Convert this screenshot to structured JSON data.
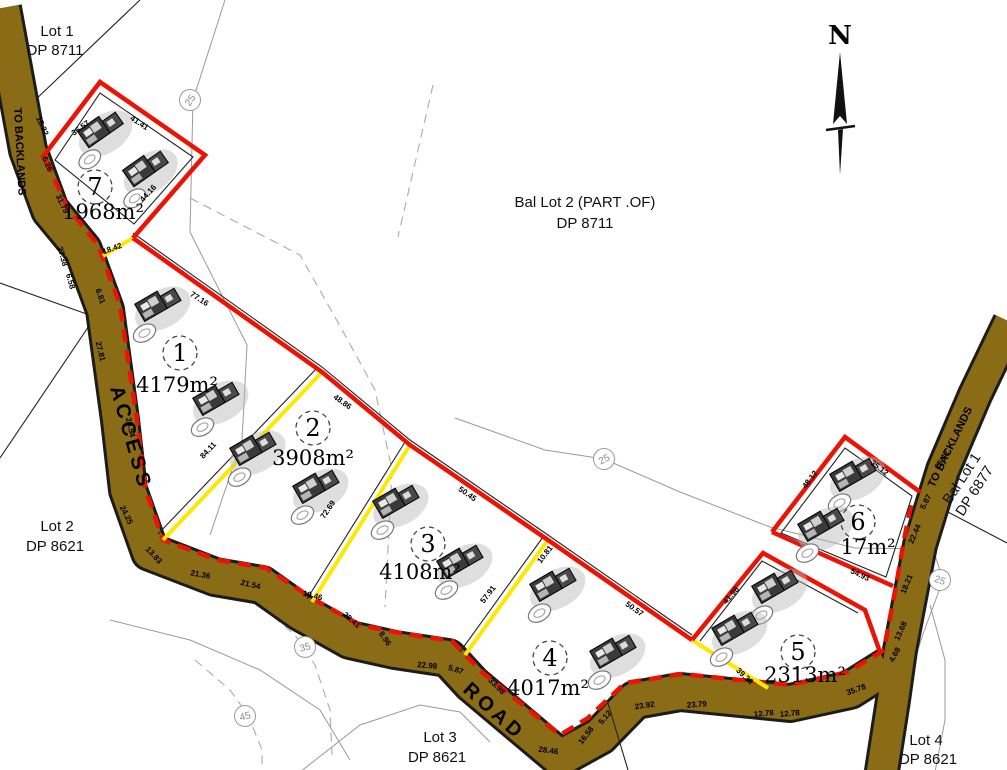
{
  "map": {
    "north_label": "N",
    "road_labels": {
      "access": "ACCESS",
      "road": "ROAD",
      "to_backlands_left": "TO BACKLANDS",
      "to_backlands_right": "TO BACKLANDS"
    },
    "adjoining": {
      "lot1": {
        "name": "Lot 1",
        "dp": "DP 8711"
      },
      "bal_lot2": {
        "name": "Bal Lot 2 (PART .OF)",
        "dp": "DP 8711"
      },
      "lot2": {
        "name": "Lot 2",
        "dp": "DP 8621"
      },
      "lot3": {
        "name": "Lot 3",
        "dp": "DP 8621"
      },
      "lot4": {
        "name": "Lot 4",
        "dp": "DP 8621"
      },
      "bal_lot1": {
        "name": "Bal Lot 1",
        "dp": "DP 6877"
      }
    },
    "parcels": [
      {
        "number": "1",
        "area": "4179m²"
      },
      {
        "number": "2",
        "area": "3908m²"
      },
      {
        "number": "3",
        "area": "4108m²"
      },
      {
        "number": "4",
        "area": "4017m²"
      },
      {
        "number": "5",
        "area": "2313m²"
      },
      {
        "number": "6",
        "area": "17m²"
      },
      {
        "number": "7",
        "area": "1968m²"
      }
    ],
    "contours": [
      "25",
      "25",
      "25",
      "35",
      "45"
    ],
    "dims": [
      "18.22",
      "6.26",
      "31.79",
      "27.38",
      "6.58",
      "6.81",
      "27.81",
      "29.54",
      "24.25",
      "13.83",
      "21.36",
      "21.54",
      "19.46",
      "29.41",
      "8.96",
      "22.98",
      "5.87",
      "33.98",
      "28.46",
      "16.58",
      "5.12",
      "23.92",
      "23.79",
      "12.78",
      "12.78",
      "35.78",
      "4.68",
      "13.68",
      "18.21",
      "22.44",
      "5.87",
      "25.42",
      "36.57",
      "41.41",
      "44.16",
      "18.42",
      "77.16",
      "48.86",
      "50.45",
      "50.57",
      "10.81",
      "41.98",
      "35.12",
      "48.12",
      "54.93",
      "84.11",
      "72.69",
      "57.91",
      "39.36"
    ]
  },
  "colors": {
    "road-fill": "#8a6b16",
    "boundary-red": "#ec1305",
    "lot-yellow": "#ffe800",
    "contour-gray": "#9a9a9a"
  }
}
